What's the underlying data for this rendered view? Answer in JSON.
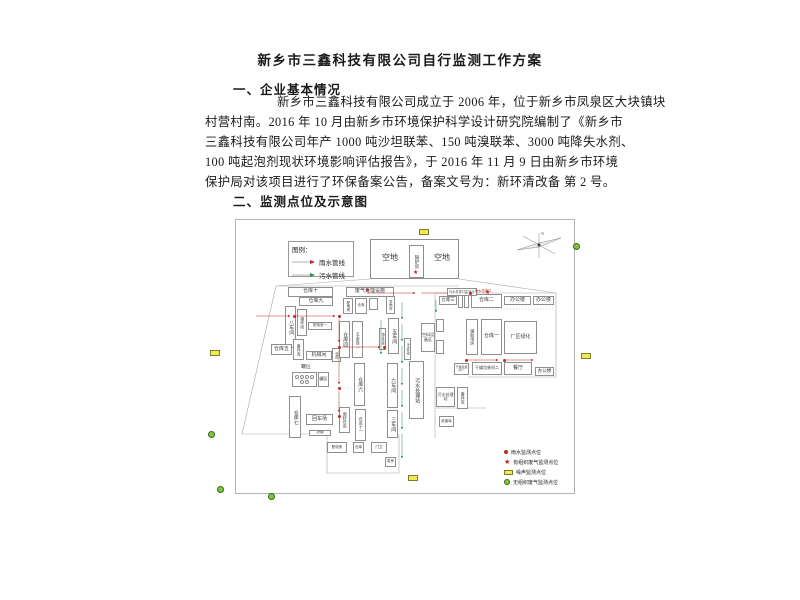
{
  "doc": {
    "title": "新乡市三鑫科技有限公司自行监测工作方案",
    "section1": "一、企业基本情况",
    "section2": "二、监测点位及示意图",
    "paragraph_lines": [
      "新乡市三鑫科技有限公司成立于 2006 年，位于新乡市凤泉区大块镇块",
      "村营村南。2016 年 10 月由新乡市环境保护科学设计研究院编制了《新乡市",
      "三鑫科技有限公司年产 1000 吨沙坦联苯、150 吨溴联苯、3000 吨降失水剂、",
      "100 吨起泡剂现状环境影响评估报告》，于 2016 年 11 月 9 日由新乡市环境",
      "保护局对该项目进行了环保备案公告，备案文号为：新环清改备 第 2 号。"
    ]
  },
  "diagram": {
    "colors": {
      "rain_line": "#c22626",
      "sewage_line": "#2e8b57",
      "noise_fill": "#f2ea4f",
      "gas_fill": "#85c23d"
    },
    "legend": {
      "title": "图例：",
      "items": [
        {
          "label": "雨水管线",
          "color": "#c22626"
        },
        {
          "label": "污水管线",
          "color": "#2e8b57"
        }
      ]
    },
    "monitor_legend": [
      {
        "marker": "dot",
        "label": "雨水监测点位"
      },
      {
        "marker": "star",
        "label": "有组织废气监测点位"
      },
      {
        "marker": "noise",
        "label": "噪声监测点位"
      },
      {
        "marker": "gas",
        "label": "无组织废气监测点位"
      }
    ],
    "compass_label": "N",
    "callouts": [
      {
        "t": "污水总排口监测点",
        "c": "#444",
        "x": 211,
        "y": 68,
        "boxed": 1
      },
      {
        "t": "雨水总排口",
        "c": "#c22626",
        "x": 239,
        "y": 68,
        "boxed": 0
      }
    ],
    "buildings": [
      {
        "l": "",
        "x": 134,
        "y": 19,
        "w": 89,
        "h": 40
      },
      {
        "l": "空地",
        "x": 138,
        "y": 30,
        "w": 32,
        "h": 16,
        "nb": 1,
        "fs": 8
      },
      {
        "l": "空地",
        "x": 190,
        "y": 30,
        "w": 32,
        "h": 16,
        "nb": 1,
        "fs": 8
      },
      {
        "l": "锅炉房",
        "x": 173,
        "y": 25,
        "w": 15,
        "h": 33,
        "v": 1,
        "fs": 4.5
      },
      {
        "l": "仓库十",
        "x": 52,
        "y": 67,
        "w": 45,
        "h": 10,
        "fs": 5
      },
      {
        "l": "仓库九",
        "x": 63,
        "y": 77,
        "w": 34,
        "h": 9,
        "fs": 5
      },
      {
        "l": "八车间",
        "x": 49,
        "y": 86,
        "w": 11,
        "h": 42,
        "v": 1,
        "fs": 5
      },
      {
        "l": "操作间",
        "x": 61,
        "y": 89,
        "w": 10,
        "h": 27,
        "v": 1,
        "fs": 4
      },
      {
        "l": "配电室一",
        "x": 72,
        "y": 102,
        "w": 24,
        "h": 8,
        "fs": 3.5
      },
      {
        "l": "仓库五",
        "x": 35,
        "y": 124,
        "w": 21,
        "h": 11,
        "fs": 5
      },
      {
        "l": "备件库",
        "x": 57,
        "y": 119,
        "w": 11,
        "h": 21,
        "v": 1,
        "fs": 4
      },
      {
        "l": "机械间",
        "x": 70,
        "y": 131,
        "w": 26,
        "h": 9,
        "fs": 5
      },
      {
        "l": "仓库",
        "x": 96,
        "y": 128,
        "w": 9,
        "h": 14,
        "v": 1,
        "fs": 3.5
      },
      {
        "l": "罐区",
        "x": 63,
        "y": 144,
        "w": 14,
        "h": 7,
        "nb": 1,
        "fs": 5
      },
      {
        "l": "",
        "x": 56,
        "y": 152,
        "w": 25,
        "h": 15,
        "tanks": 1
      },
      {
        "l": "罐区",
        "x": 82,
        "y": 152,
        "w": 11,
        "h": 15,
        "fs": 4
      },
      {
        "l": "仓库七",
        "x": 53,
        "y": 176,
        "w": 12,
        "h": 42,
        "v": 1,
        "fs": 5
      },
      {
        "l": "回车场",
        "x": 70,
        "y": 194,
        "w": 27,
        "h": 11,
        "fs": 5
      },
      {
        "l": "凉棚",
        "x": 73,
        "y": 210,
        "w": 22,
        "h": 6,
        "fs": 3.5
      },
      {
        "l": "废气处理设施",
        "x": 110,
        "y": 67,
        "w": 48,
        "h": 10,
        "fs": 5
      },
      {
        "l": "配电房",
        "x": 107,
        "y": 78,
        "w": 10,
        "h": 16,
        "v": 1,
        "fs": 3.5
      },
      {
        "l": "仓库",
        "x": 119,
        "y": 78,
        "w": 12,
        "h": 16,
        "fs": 3.5
      },
      {
        "l": "",
        "x": 133,
        "y": 78,
        "w": 9,
        "h": 12
      },
      {
        "l": "变电所",
        "x": 150,
        "y": 76,
        "w": 9,
        "h": 18,
        "v": 1,
        "fs": 3.5
      },
      {
        "l": "仓库四",
        "x": 103,
        "y": 101,
        "w": 11,
        "h": 37,
        "v": 1,
        "fs": 5
      },
      {
        "l": "五金库二",
        "x": 116,
        "y": 101,
        "w": 11,
        "h": 37,
        "v": 1,
        "fs": 4
      },
      {
        "l": "五车间",
        "x": 152,
        "y": 98,
        "w": 11,
        "h": 36,
        "v": 1,
        "fs": 5
      },
      {
        "l": "雨水管线",
        "x": 143,
        "y": 108,
        "w": 7,
        "h": 22,
        "v": 1,
        "fs": 3
      },
      {
        "l": "污水管线",
        "x": 168,
        "y": 118,
        "w": 7,
        "h": 22,
        "v": 1,
        "fs": 3
      },
      {
        "l": "仓库六",
        "x": 118,
        "y": 143,
        "w": 11,
        "h": 43,
        "v": 1,
        "fs": 5
      },
      {
        "l": "六车间",
        "x": 151,
        "y": 143,
        "w": 11,
        "h": 45,
        "v": 1,
        "fs": 5
      },
      {
        "l": "三车间",
        "x": 151,
        "y": 190,
        "w": 11,
        "h": 28,
        "v": 1,
        "fs": 5
      },
      {
        "l": "仓库十一",
        "x": 119,
        "y": 189,
        "w": 11,
        "h": 32,
        "v": 1,
        "fs": 4
      },
      {
        "l": "周转仓库",
        "x": 103,
        "y": 187,
        "w": 11,
        "h": 26,
        "v": 1,
        "fs": 4
      },
      {
        "l": "污水处理站",
        "x": 173,
        "y": 141,
        "w": 15,
        "h": 58,
        "v": 1,
        "fs": 5
      },
      {
        "l": "空料设备区",
        "x": 185,
        "y": 103,
        "w": 14,
        "h": 29,
        "fs": 4
      },
      {
        "l": "配电房",
        "x": 91,
        "y": 222,
        "w": 20,
        "h": 11,
        "fs": 3.5
      },
      {
        "l": "仓库",
        "x": 117,
        "y": 222,
        "w": 11,
        "h": 11,
        "fs": 3.5
      },
      {
        "l": "门卫",
        "x": 135,
        "y": 222,
        "w": 16,
        "h": 11,
        "fs": 3.5
      },
      {
        "l": "泵房",
        "x": 149,
        "y": 237,
        "w": 11,
        "h": 10,
        "fs": 3.5
      },
      {
        "l": "仓库三",
        "x": 203,
        "y": 76,
        "w": 18,
        "h": 9,
        "fs": 4.5
      },
      {
        "l": "",
        "x": 222,
        "y": 73,
        "w": 5,
        "h": 15
      },
      {
        "l": "",
        "x": 228,
        "y": 73,
        "w": 5,
        "h": 15
      },
      {
        "l": "仓库二",
        "x": 235,
        "y": 74,
        "w": 31,
        "h": 14,
        "fs": 5
      },
      {
        "l": "办公楼",
        "x": 268,
        "y": 76,
        "w": 27,
        "h": 9,
        "fs": 5
      },
      {
        "l": "办公楼",
        "x": 297,
        "y": 76,
        "w": 21,
        "h": 9,
        "fs": 5
      },
      {
        "l": "辅助用房",
        "x": 230,
        "y": 99,
        "w": 12,
        "h": 36,
        "v": 1,
        "fs": 4
      },
      {
        "l": "仓库一",
        "x": 245,
        "y": 99,
        "w": 21,
        "h": 36,
        "fs": 5
      },
      {
        "l": "厂区绿化",
        "x": 268,
        "y": 101,
        "w": 33,
        "h": 33,
        "fs": 5
      },
      {
        "l": "干燥包装间一",
        "x": 218,
        "y": 143,
        "w": 15,
        "h": 12,
        "fs": 3
      },
      {
        "l": "干燥包装间二",
        "x": 236,
        "y": 142,
        "w": 30,
        "h": 13,
        "fs": 4
      },
      {
        "l": "餐厅",
        "x": 268,
        "y": 142,
        "w": 28,
        "h": 13,
        "fs": 5
      },
      {
        "l": "办公楼",
        "x": 299,
        "y": 147,
        "w": 19,
        "h": 9,
        "fs": 4.5
      },
      {
        "l": "污水处理站",
        "x": 200,
        "y": 167,
        "w": 19,
        "h": 20,
        "fs": 4
      },
      {
        "l": "备件库",
        "x": 221,
        "y": 167,
        "w": 11,
        "h": 22,
        "v": 1,
        "fs": 4
      },
      {
        "l": "危废库",
        "x": 203,
        "y": 196,
        "w": 15,
        "h": 11,
        "fs": 3.5
      },
      {
        "l": "",
        "x": 200,
        "y": 99,
        "w": 8,
        "h": 13
      },
      {
        "l": "",
        "x": 200,
        "y": 120,
        "w": 8,
        "h": 14
      }
    ],
    "markers": {
      "stars": [
        [
          129,
          68
        ],
        [
          177,
          50
        ],
        [
          249,
          70
        ]
      ],
      "dots": [
        [
          57,
          95
        ],
        [
          102,
          95
        ],
        [
          102,
          126
        ],
        [
          102,
          167
        ],
        [
          102,
          195
        ],
        [
          147,
          126
        ],
        [
          233,
          72
        ],
        [
          229,
          139
        ],
        [
          267,
          139
        ]
      ],
      "noise": [
        [
          419,
          229
        ],
        [
          210,
          350
        ],
        [
          581,
          353
        ],
        [
          408,
          475
        ]
      ],
      "gas": [
        [
          573,
          243
        ],
        [
          208,
          431
        ],
        [
          217,
          486
        ],
        [
          268,
          493
        ]
      ]
    }
  }
}
